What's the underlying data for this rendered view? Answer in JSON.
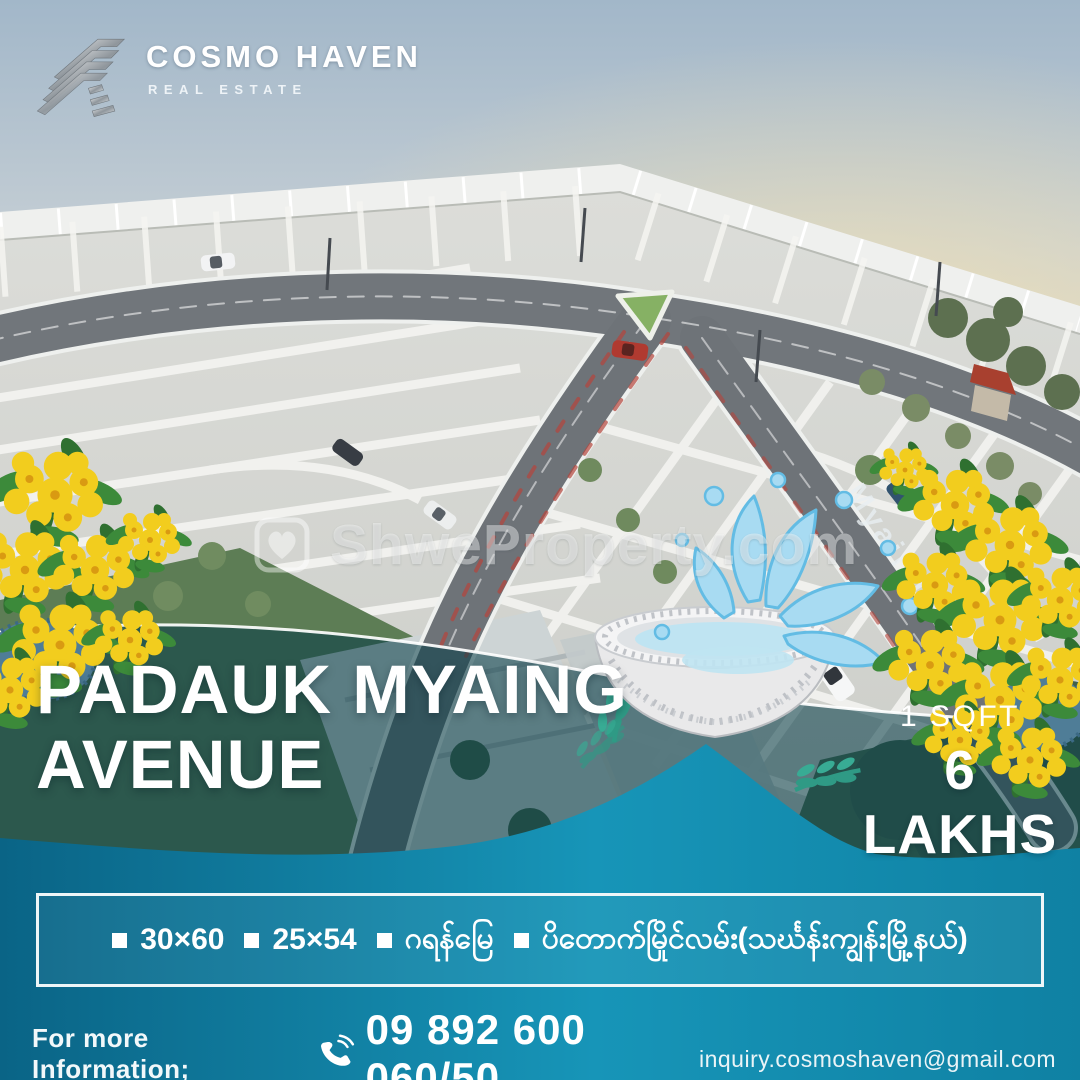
{
  "brand": {
    "name": "COSMO HAVEN",
    "tagline": "REAL ESTATE",
    "logo_icon": "silver-chevron-logo"
  },
  "watermark": {
    "text": "ShweProperty.com",
    "icon": "house-heart-icon"
  },
  "scene": {
    "street_label": "Myaing St"
  },
  "title": {
    "line1": "PADAUK MYAING",
    "line2": "AVENUE"
  },
  "price": {
    "unit": "1 SQFT",
    "value": "6 LAKHS"
  },
  "banner": {
    "items": [
      {
        "label": "30×60"
      },
      {
        "label": "25×54"
      },
      {
        "label": "ဂရန်မြေ"
      },
      {
        "label": "ပိတောက်မြိုင်လမ်း(သင်္ဃန်းကျွန်းမြို့နယ်)"
      }
    ]
  },
  "footer": {
    "label": "For more Information;",
    "phone": "09 892 600 060/50",
    "email": "inquiry.cosmoshaven@gmail.com",
    "phone_icon": "phone-icon"
  },
  "colors": {
    "teal_dark": "#0a6486",
    "teal_mid": "#1795b8",
    "teal_deep": "#0f81a3",
    "overlay_tint": "rgba(9,62,72,0.58)",
    "banner_border": "#eef6f8",
    "flower_yellow": "#f2cd1e",
    "splash_blue": "#a8dbf2",
    "sky_top": "#a2b7c9",
    "sunset": "#eedfbd"
  }
}
